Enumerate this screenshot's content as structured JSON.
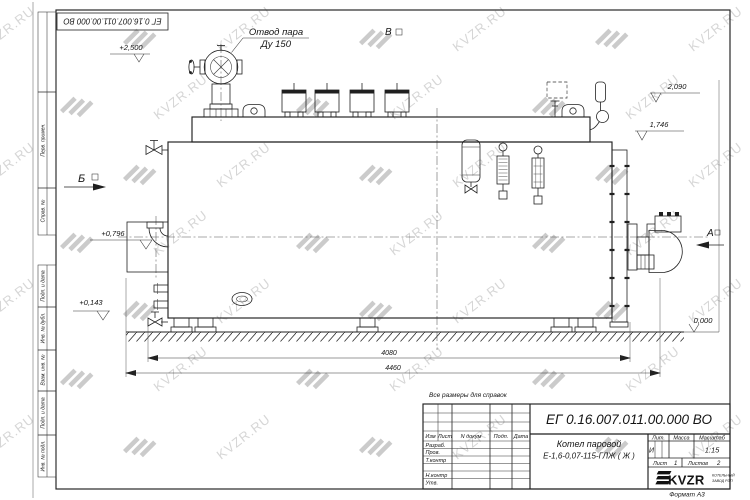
{
  "sheet": {
    "doc_number": "ЕГ 0.16.007.011.00.000  ВО",
    "format_note": "Формат  А3",
    "reference_note": "Все размеры для справок"
  },
  "watermark": {
    "text": "KVZR.RU"
  },
  "frame_labels": {
    "perv_primen": "Перв. примен.",
    "sprav_no": "Справ. №",
    "podp_data_1": "Подп. и дата",
    "inv_dubl": "Инв. № дубл.",
    "vzam_inv": "Взам. инв. №",
    "podp_data_2": "Подп. и дата",
    "inv_podl": "Инв. № подл."
  },
  "drawing": {
    "steam_outlet_label_line1": "Отвод пара",
    "steam_outlet_label_line2": "Ду 150",
    "elevations": {
      "steam_outlet": "+2,500",
      "drum_top": "2,090",
      "shell_top": "1,746",
      "front_axis": "+0,796",
      "lower_fitting": "+0,143",
      "ground": "0,000"
    },
    "dimensions": {
      "support_span": "4080",
      "overall_length": "4460"
    },
    "view_markers": {
      "left": "Б",
      "top": "В",
      "right": "А"
    }
  },
  "title_block": {
    "doc_number": "ЕГ 0.16.007.011.00.000  ВО",
    "product_line1": "Котел паровой",
    "product_line2": "Е-1,6-0,07-115-ГЛЖ ( Ж )",
    "cols": {
      "izm": "Изм",
      "list": "Лист",
      "n_dokum": "N докум",
      "podp": "Подп.",
      "data": "Дата"
    },
    "rows": {
      "razrab": "Разраб.",
      "prov": "Пров.",
      "tkontr": "Т.контр",
      "nkontr": "Н.контр",
      "utv": "Утв."
    },
    "lit_label": "Лит.",
    "massa_label": "Масса",
    "masshtab_label": "Масштаб",
    "lit_value": "И",
    "scale_value": "1:15",
    "list_label": "Лист",
    "list_value": "1",
    "listov_label": "Листов",
    "listov_value": "2",
    "logo_text": "KVZR",
    "company_line1": "КОТЕЛЬНЫЙ",
    "company_line2": "ЗАВОД РЭП"
  }
}
